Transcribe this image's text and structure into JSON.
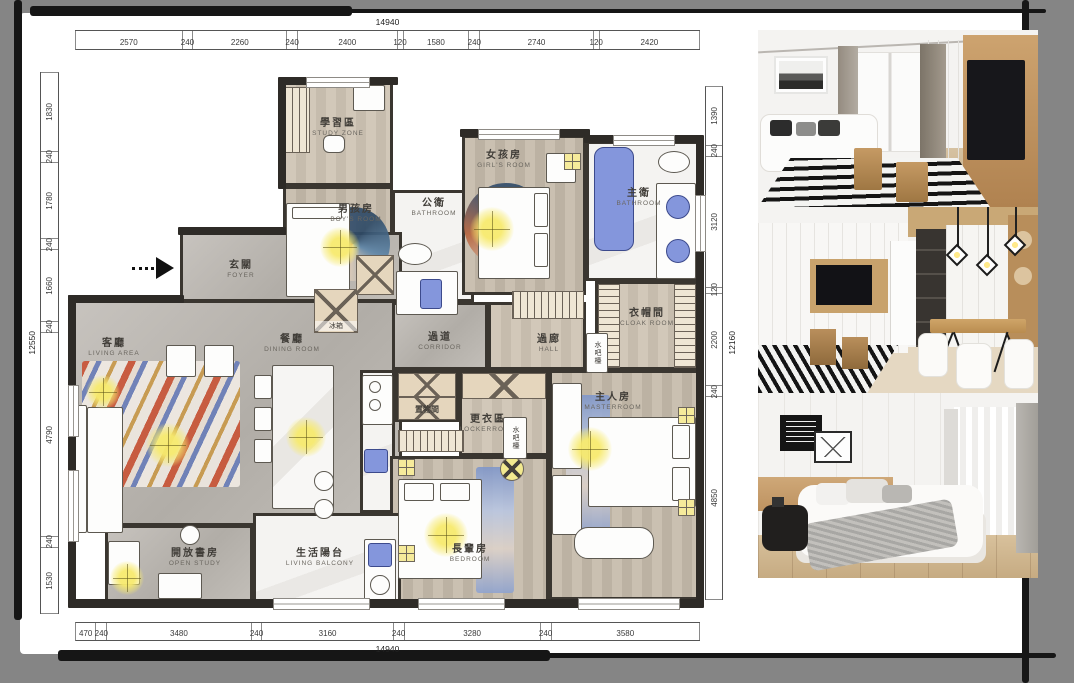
{
  "board": {
    "outer_bg": "#858585",
    "panel_bg": "#ffffff",
    "frame_stroke": "#161616"
  },
  "dimensions": {
    "top": {
      "total": "14940",
      "segments": [
        2570,
        240,
        2260,
        240,
        2400,
        120,
        1580,
        240,
        2740,
        120,
        2420
      ]
    },
    "bottom": {
      "total": "14940",
      "segments": [
        470,
        240,
        3480,
        240,
        3160,
        240,
        3280,
        240,
        3580
      ]
    },
    "left": {
      "total": "12550",
      "segments": [
        1830,
        240,
        1780,
        240,
        1660,
        240,
        4790,
        240,
        1530
      ]
    },
    "right": {
      "total": "12160",
      "segments": [
        1390,
        240,
        3120,
        120,
        2200,
        240,
        4850
      ]
    }
  },
  "rooms": {
    "study_zone": {
      "zh": "學習區",
      "en": "STUDY ZONE"
    },
    "boys_room": {
      "zh": "男孩房",
      "en": "BOY'S ROOM"
    },
    "public_bath": {
      "zh": "公衛",
      "en": "BATHROOM"
    },
    "girls_room": {
      "zh": "女孩房",
      "en": "GIRL'S ROOM"
    },
    "master_bath": {
      "zh": "主衛",
      "en": "BATHROOM"
    },
    "foyer": {
      "zh": "玄關",
      "en": "FOYER"
    },
    "living": {
      "zh": "客廳",
      "en": "LIVING AREA"
    },
    "dining": {
      "zh": "餐廳",
      "en": "DINING ROOM"
    },
    "corridor": {
      "zh": "過道",
      "en": "CORRIDOR"
    },
    "hall": {
      "zh": "過廊",
      "en": "HALL"
    },
    "cloak": {
      "zh": "衣帽間",
      "en": "CLOAK ROOM"
    },
    "storage": {
      "zh": "置物間",
      "en": ""
    },
    "locker": {
      "zh": "更衣區",
      "en": "LOCKERROOM"
    },
    "master": {
      "zh": "主人房",
      "en": "MASTERROOM"
    },
    "elder": {
      "zh": "長輩房",
      "en": "BEDROOM"
    },
    "open_study": {
      "zh": "開放書房",
      "en": "OPEN STUDY"
    },
    "balcony": {
      "zh": "生活陽台",
      "en": "LIVING BALCONY"
    },
    "water_bar": {
      "zh": "水吧檯"
    },
    "fridge": {
      "zh": "冰箱"
    }
  },
  "photos": [
    {
      "name": "living-room-photo"
    },
    {
      "name": "dining-area-photo"
    },
    {
      "name": "bedroom-photo"
    }
  ],
  "colors": {
    "accent_blue": "#8496dc",
    "light_yellow": "#f3e784",
    "wall": "#2e2b27"
  }
}
